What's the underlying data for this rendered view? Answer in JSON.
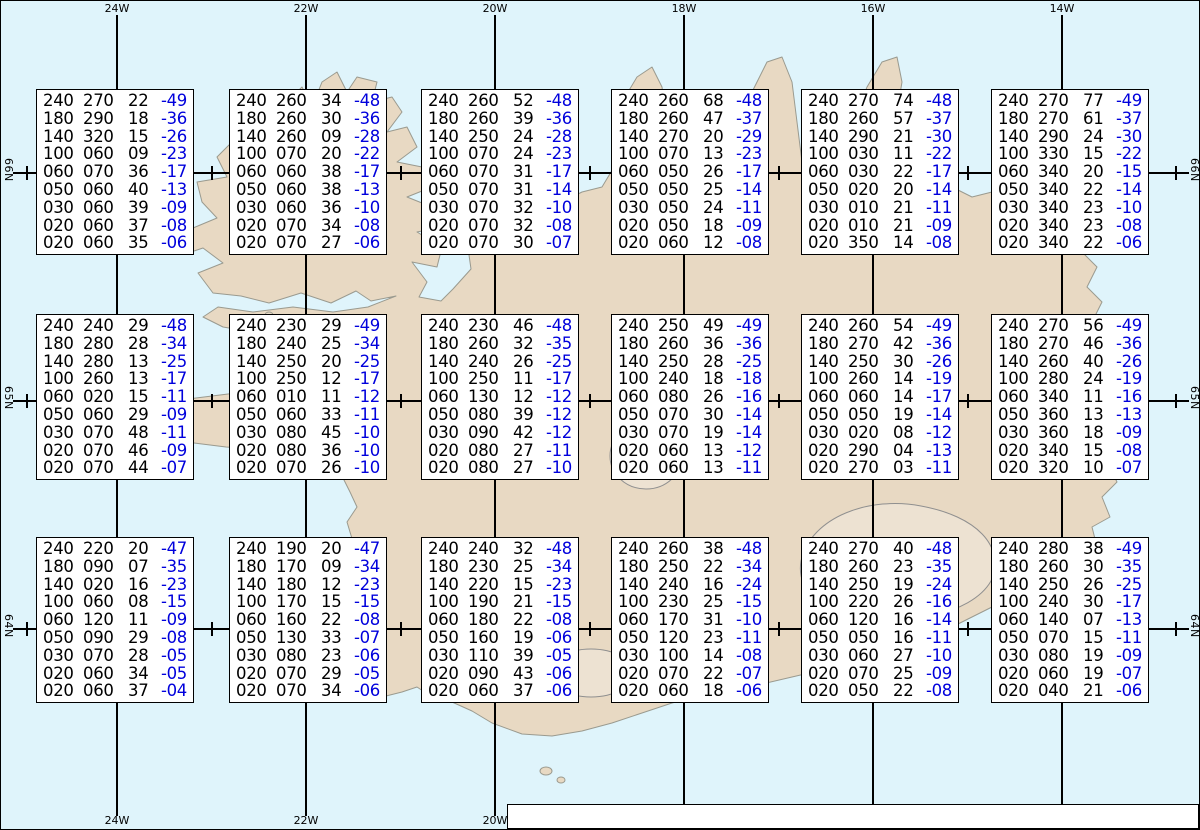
{
  "map": {
    "region": "Iceland",
    "colors": {
      "sea": "#DFF4FB",
      "land": "#E8D9C3",
      "coast": "#9A9A8F",
      "glacier_outline": "#8F8F8F",
      "grid": "#000000",
      "temp_blue": "#0000DC"
    },
    "meridians": [
      {
        "label": "24W",
        "x": 116
      },
      {
        "label": "22W",
        "x": 305
      },
      {
        "label": "20W",
        "x": 494
      },
      {
        "label": "18W",
        "x": 683
      },
      {
        "label": "16W",
        "x": 872
      },
      {
        "label": "14W",
        "x": 1061
      }
    ],
    "bottom_visible": [
      "24W",
      "22W",
      "20W"
    ],
    "parallels": [
      {
        "label": "66N",
        "y": 172
      },
      {
        "label": "65N",
        "y": 400
      },
      {
        "label": "64N",
        "y": 628
      }
    ],
    "tick_xs": [
      26,
      211,
      400,
      589,
      778,
      967,
      1175
    ],
    "meridian_top_y": 14,
    "meridian_bottom_y": 815,
    "parallel_left_x": 12,
    "parallel_right_x": 1188
  },
  "spot_table": {
    "columns": [
      "FL",
      "Dir",
      "KT",
      "°C"
    ],
    "boxes": [
      {
        "x": 35,
        "y": 88,
        "rows": [
          [
            "240",
            "270",
            "22",
            "-49"
          ],
          [
            "180",
            "290",
            "18",
            "-36"
          ],
          [
            "140",
            "320",
            "15",
            "-26"
          ],
          [
            "100",
            "060",
            "09",
            "-23"
          ],
          [
            "060",
            "070",
            "36",
            "-17"
          ],
          [
            "050",
            "060",
            "40",
            "-13"
          ],
          [
            "030",
            "060",
            "39",
            "-09"
          ],
          [
            "020",
            "060",
            "37",
            "-08"
          ],
          [
            "020",
            "060",
            "35",
            "-06"
          ]
        ]
      },
      {
        "x": 228,
        "y": 88,
        "rows": [
          [
            "240",
            "260",
            "34",
            "-48"
          ],
          [
            "180",
            "260",
            "30",
            "-36"
          ],
          [
            "140",
            "260",
            "09",
            "-28"
          ],
          [
            "100",
            "070",
            "20",
            "-22"
          ],
          [
            "060",
            "060",
            "38",
            "-17"
          ],
          [
            "050",
            "060",
            "38",
            "-13"
          ],
          [
            "030",
            "060",
            "36",
            "-10"
          ],
          [
            "020",
            "070",
            "34",
            "-08"
          ],
          [
            "020",
            "070",
            "27",
            "-06"
          ]
        ]
      },
      {
        "x": 420,
        "y": 88,
        "rows": [
          [
            "240",
            "260",
            "52",
            "-48"
          ],
          [
            "180",
            "260",
            "39",
            "-36"
          ],
          [
            "140",
            "250",
            "24",
            "-28"
          ],
          [
            "100",
            "070",
            "24",
            "-23"
          ],
          [
            "060",
            "070",
            "31",
            "-17"
          ],
          [
            "050",
            "070",
            "31",
            "-14"
          ],
          [
            "030",
            "070",
            "32",
            "-10"
          ],
          [
            "020",
            "070",
            "32",
            "-08"
          ],
          [
            "020",
            "070",
            "30",
            "-07"
          ]
        ]
      },
      {
        "x": 610,
        "y": 88,
        "rows": [
          [
            "240",
            "260",
            "68",
            "-48"
          ],
          [
            "180",
            "260",
            "47",
            "-37"
          ],
          [
            "140",
            "270",
            "20",
            "-29"
          ],
          [
            "100",
            "070",
            "13",
            "-23"
          ],
          [
            "060",
            "050",
            "26",
            "-17"
          ],
          [
            "050",
            "050",
            "25",
            "-14"
          ],
          [
            "030",
            "050",
            "24",
            "-11"
          ],
          [
            "020",
            "050",
            "18",
            "-09"
          ],
          [
            "020",
            "060",
            "12",
            "-08"
          ]
        ]
      },
      {
        "x": 800,
        "y": 88,
        "rows": [
          [
            "240",
            "270",
            "74",
            "-48"
          ],
          [
            "180",
            "260",
            "57",
            "-37"
          ],
          [
            "140",
            "290",
            "21",
            "-30"
          ],
          [
            "100",
            "030",
            "11",
            "-22"
          ],
          [
            "060",
            "030",
            "22",
            "-17"
          ],
          [
            "050",
            "020",
            "20",
            "-14"
          ],
          [
            "030",
            "010",
            "21",
            "-11"
          ],
          [
            "020",
            "010",
            "21",
            "-09"
          ],
          [
            "020",
            "350",
            "14",
            "-08"
          ]
        ]
      },
      {
        "x": 990,
        "y": 88,
        "rows": [
          [
            "240",
            "270",
            "77",
            "-49"
          ],
          [
            "180",
            "270",
            "61",
            "-37"
          ],
          [
            "140",
            "290",
            "24",
            "-30"
          ],
          [
            "100",
            "330",
            "15",
            "-22"
          ],
          [
            "060",
            "340",
            "20",
            "-15"
          ],
          [
            "050",
            "340",
            "22",
            "-14"
          ],
          [
            "030",
            "340",
            "23",
            "-10"
          ],
          [
            "020",
            "340",
            "23",
            "-08"
          ],
          [
            "020",
            "340",
            "22",
            "-06"
          ]
        ]
      },
      {
        "x": 35,
        "y": 313,
        "rows": [
          [
            "240",
            "240",
            "29",
            "-48"
          ],
          [
            "180",
            "280",
            "28",
            "-34"
          ],
          [
            "140",
            "280",
            "13",
            "-25"
          ],
          [
            "100",
            "260",
            "13",
            "-17"
          ],
          [
            "060",
            "020",
            "15",
            "-11"
          ],
          [
            "050",
            "060",
            "29",
            "-09"
          ],
          [
            "030",
            "070",
            "48",
            "-11"
          ],
          [
            "020",
            "070",
            "46",
            "-09"
          ],
          [
            "020",
            "070",
            "44",
            "-07"
          ]
        ]
      },
      {
        "x": 228,
        "y": 313,
        "rows": [
          [
            "240",
            "230",
            "29",
            "-49"
          ],
          [
            "180",
            "240",
            "25",
            "-34"
          ],
          [
            "140",
            "250",
            "20",
            "-25"
          ],
          [
            "100",
            "250",
            "12",
            "-17"
          ],
          [
            "060",
            "010",
            "11",
            "-12"
          ],
          [
            "050",
            "060",
            "33",
            "-11"
          ],
          [
            "030",
            "080",
            "45",
            "-10"
          ],
          [
            "020",
            "080",
            "36",
            "-10"
          ],
          [
            "020",
            "070",
            "26",
            "-10"
          ]
        ]
      },
      {
        "x": 420,
        "y": 313,
        "rows": [
          [
            "240",
            "230",
            "46",
            "-48"
          ],
          [
            "180",
            "260",
            "32",
            "-35"
          ],
          [
            "140",
            "240",
            "26",
            "-25"
          ],
          [
            "100",
            "250",
            "11",
            "-17"
          ],
          [
            "060",
            "130",
            "12",
            "-12"
          ],
          [
            "050",
            "080",
            "39",
            "-12"
          ],
          [
            "030",
            "090",
            "42",
            "-12"
          ],
          [
            "020",
            "080",
            "27",
            "-11"
          ],
          [
            "020",
            "080",
            "27",
            "-10"
          ]
        ]
      },
      {
        "x": 610,
        "y": 313,
        "rows": [
          [
            "240",
            "250",
            "49",
            "-49"
          ],
          [
            "180",
            "260",
            "36",
            "-36"
          ],
          [
            "140",
            "250",
            "28",
            "-25"
          ],
          [
            "100",
            "240",
            "18",
            "-18"
          ],
          [
            "060",
            "080",
            "26",
            "-16"
          ],
          [
            "050",
            "070",
            "30",
            "-14"
          ],
          [
            "030",
            "070",
            "19",
            "-14"
          ],
          [
            "020",
            "060",
            "13",
            "-12"
          ],
          [
            "020",
            "060",
            "13",
            "-11"
          ]
        ]
      },
      {
        "x": 800,
        "y": 313,
        "rows": [
          [
            "240",
            "260",
            "54",
            "-49"
          ],
          [
            "180",
            "270",
            "42",
            "-36"
          ],
          [
            "140",
            "250",
            "30",
            "-26"
          ],
          [
            "100",
            "260",
            "14",
            "-19"
          ],
          [
            "060",
            "060",
            "14",
            "-17"
          ],
          [
            "050",
            "050",
            "19",
            "-14"
          ],
          [
            "030",
            "020",
            "08",
            "-12"
          ],
          [
            "020",
            "290",
            "04",
            "-13"
          ],
          [
            "020",
            "270",
            "03",
            "-11"
          ]
        ]
      },
      {
        "x": 990,
        "y": 313,
        "rows": [
          [
            "240",
            "270",
            "56",
            "-49"
          ],
          [
            "180",
            "270",
            "46",
            "-36"
          ],
          [
            "140",
            "260",
            "40",
            "-26"
          ],
          [
            "100",
            "280",
            "24",
            "-19"
          ],
          [
            "060",
            "340",
            "11",
            "-16"
          ],
          [
            "050",
            "360",
            "13",
            "-13"
          ],
          [
            "030",
            "360",
            "18",
            "-09"
          ],
          [
            "020",
            "340",
            "15",
            "-08"
          ],
          [
            "020",
            "320",
            "10",
            "-07"
          ]
        ]
      },
      {
        "x": 35,
        "y": 536,
        "rows": [
          [
            "240",
            "220",
            "20",
            "-47"
          ],
          [
            "180",
            "090",
            "07",
            "-35"
          ],
          [
            "140",
            "020",
            "16",
            "-23"
          ],
          [
            "100",
            "060",
            "08",
            "-15"
          ],
          [
            "060",
            "120",
            "11",
            "-09"
          ],
          [
            "050",
            "090",
            "29",
            "-08"
          ],
          [
            "030",
            "070",
            "28",
            "-05"
          ],
          [
            "020",
            "060",
            "34",
            "-05"
          ],
          [
            "020",
            "060",
            "37",
            "-04"
          ]
        ]
      },
      {
        "x": 228,
        "y": 536,
        "rows": [
          [
            "240",
            "190",
            "20",
            "-47"
          ],
          [
            "180",
            "170",
            "09",
            "-34"
          ],
          [
            "140",
            "180",
            "12",
            "-23"
          ],
          [
            "100",
            "170",
            "15",
            "-15"
          ],
          [
            "060",
            "160",
            "22",
            "-08"
          ],
          [
            "050",
            "130",
            "33",
            "-07"
          ],
          [
            "030",
            "080",
            "23",
            "-06"
          ],
          [
            "020",
            "070",
            "29",
            "-05"
          ],
          [
            "020",
            "070",
            "34",
            "-06"
          ]
        ]
      },
      {
        "x": 420,
        "y": 536,
        "rows": [
          [
            "240",
            "240",
            "32",
            "-48"
          ],
          [
            "180",
            "230",
            "25",
            "-34"
          ],
          [
            "140",
            "220",
            "15",
            "-23"
          ],
          [
            "100",
            "190",
            "21",
            "-15"
          ],
          [
            "060",
            "180",
            "22",
            "-08"
          ],
          [
            "050",
            "160",
            "19",
            "-06"
          ],
          [
            "030",
            "110",
            "39",
            "-05"
          ],
          [
            "020",
            "090",
            "43",
            "-06"
          ],
          [
            "020",
            "060",
            "37",
            "-06"
          ]
        ]
      },
      {
        "x": 610,
        "y": 536,
        "rows": [
          [
            "240",
            "260",
            "38",
            "-48"
          ],
          [
            "180",
            "250",
            "22",
            "-34"
          ],
          [
            "140",
            "240",
            "16",
            "-24"
          ],
          [
            "100",
            "230",
            "25",
            "-15"
          ],
          [
            "060",
            "170",
            "31",
            "-10"
          ],
          [
            "050",
            "120",
            "23",
            "-11"
          ],
          [
            "030",
            "100",
            "14",
            "-08"
          ],
          [
            "020",
            "070",
            "22",
            "-07"
          ],
          [
            "020",
            "060",
            "18",
            "-06"
          ]
        ]
      },
      {
        "x": 800,
        "y": 536,
        "rows": [
          [
            "240",
            "270",
            "40",
            "-48"
          ],
          [
            "180",
            "260",
            "23",
            "-35"
          ],
          [
            "140",
            "250",
            "19",
            "-24"
          ],
          [
            "100",
            "220",
            "26",
            "-16"
          ],
          [
            "060",
            "120",
            "16",
            "-14"
          ],
          [
            "050",
            "050",
            "16",
            "-11"
          ],
          [
            "030",
            "060",
            "27",
            "-10"
          ],
          [
            "020",
            "070",
            "25",
            "-09"
          ],
          [
            "020",
            "050",
            "22",
            "-08"
          ]
        ]
      },
      {
        "x": 990,
        "y": 536,
        "rows": [
          [
            "240",
            "280",
            "38",
            "-49"
          ],
          [
            "180",
            "260",
            "30",
            "-35"
          ],
          [
            "140",
            "250",
            "26",
            "-25"
          ],
          [
            "100",
            "240",
            "30",
            "-17"
          ],
          [
            "060",
            "140",
            "07",
            "-13"
          ],
          [
            "050",
            "070",
            "15",
            "-11"
          ],
          [
            "030",
            "080",
            "19",
            "-09"
          ],
          [
            "020",
            "060",
            "19",
            "-07"
          ],
          [
            "020",
            "040",
            "21",
            "-06"
          ]
        ]
      }
    ]
  },
  "status_bar": {
    "segments": [
      {
        "text": "Spot Chart: FL Dir KT °C ",
        "bold": false
      },
      {
        "text": "UWC/IG-IS:",
        "bold": true
      },
      {
        "text": " IT: þri. 17. Feb. 2026 03Z ",
        "bold": false
      },
      {
        "text": "VT: Mið. 18.02.2026 04Z",
        "bold": true
      },
      {
        "text": " (+25 h)",
        "bold": false
      }
    ]
  }
}
